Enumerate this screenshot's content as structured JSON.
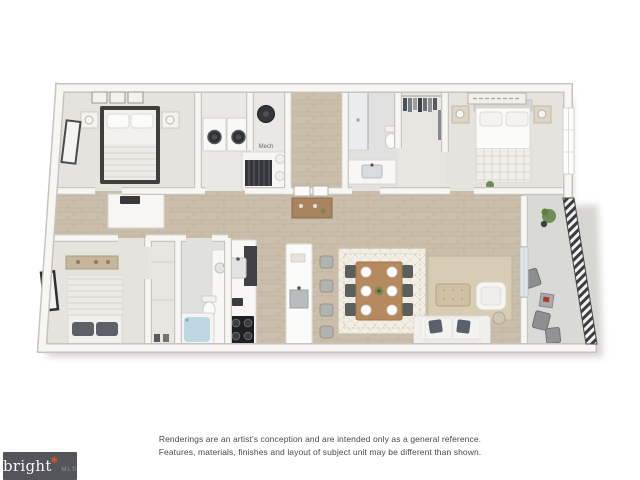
{
  "floorplan": {
    "mech_label": "Mech"
  },
  "disclaimer": {
    "line1": "Renderings are an artist's conception and are intended only as a general reference.",
    "line2": "Features, materials, finishes and layout of subject unit may be different than shown."
  },
  "logo": {
    "brand": "bright",
    "mark": "✱",
    "suffix": "MLS"
  },
  "colors": {
    "logo_bg": "#54555A",
    "logo_accent": "#CF5328",
    "wall": "#F7F6F3",
    "wall_edge": "#C9C6C1",
    "wood_floor": "#CBBFAC",
    "carpet": "#E5E3DE",
    "balcony_floor": "#D9D9D6",
    "railing": "#3C3D3F",
    "tub_water": "#BDD8E2",
    "disclaimer_text": "#4A4A4A"
  }
}
